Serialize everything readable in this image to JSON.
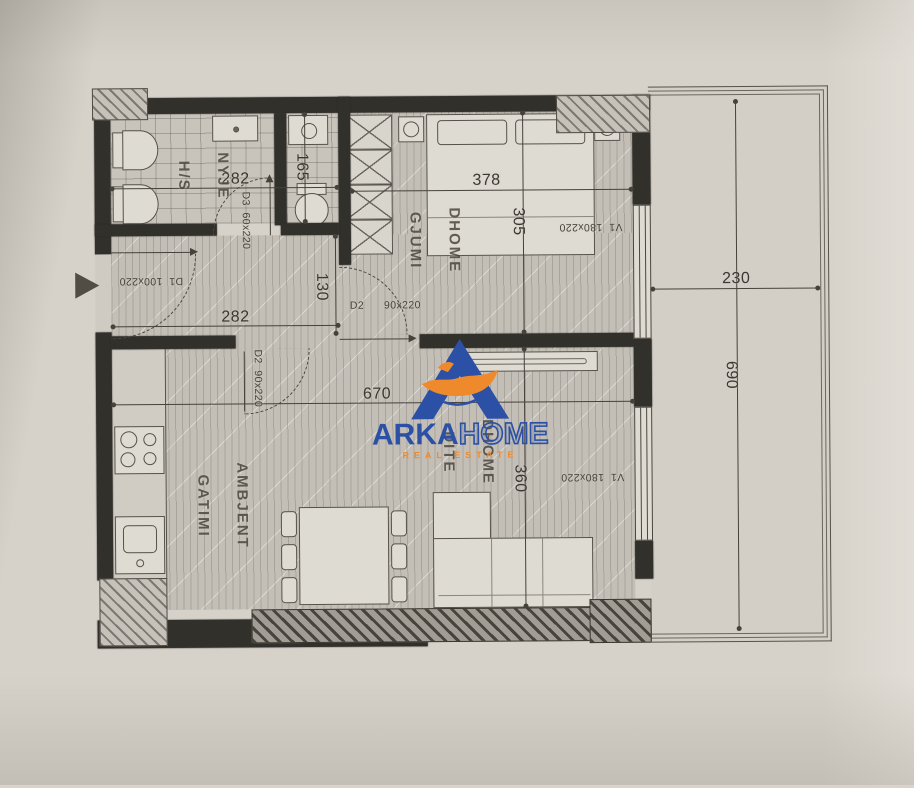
{
  "watermark": {
    "brand_primary": "ARKA",
    "brand_secondary": "HOME",
    "tagline": "REAL ESTATE",
    "colors": {
      "blue": "#2b50a5",
      "orange": "#ef8a2c"
    }
  },
  "plan": {
    "rooms": {
      "bathroom": {
        "line1": "NYJE",
        "line2": "H/S"
      },
      "bedroom": {
        "line1": "DHOME",
        "line2": "GJUMI"
      },
      "kitchen": {
        "line1": "AMBJENT",
        "line2": "GATIMI"
      },
      "living": {
        "line1": "DHOME",
        "line2": "DITE"
      }
    },
    "dimensions": {
      "bathroom_width": "282",
      "utility_height": "165",
      "bedroom_width": "378",
      "bedroom_depth": "305",
      "hall_width": "282",
      "hall_height": "130",
      "living_width": "670",
      "living_depth": "360",
      "terrace_width": "230",
      "terrace_depth": "690"
    },
    "doors": {
      "entry": "D1  100x220",
      "bathroom": "D3  60x220",
      "bedroom": "D2      90x220",
      "living": "D2  90x220"
    },
    "windows": {
      "bedroom": "V1  180x220",
      "living": "V1  180x220"
    }
  }
}
